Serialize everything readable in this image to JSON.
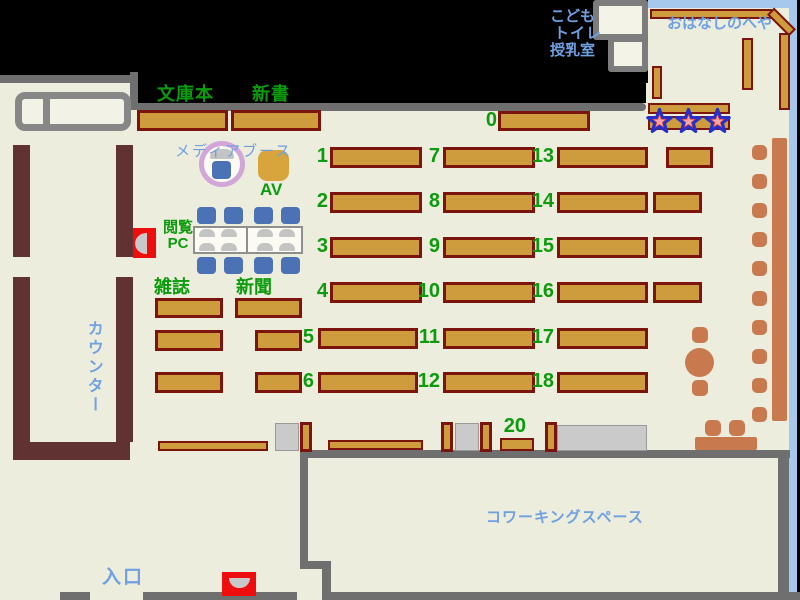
{
  "palette": {
    "green": "#0C9B0C",
    "blue": "#6FA0E2",
    "shelf_fill": "#CF9C3D",
    "shelf_border": "#7B150C",
    "counter_brown": "#603231",
    "wall_grey": "#6F6F6F",
    "floor_beige": "#EDEDDD",
    "salmon": "#C9794E",
    "chair_blue": "#4B72B5",
    "window_blue": "#A6C8EC",
    "return_red": "#EE0E0E",
    "star_red": "#E03434",
    "star_outline": "#2430CC",
    "media_ring_plum": "#D2A6D8"
  },
  "area_labels": [
    {
      "name": "label-bunkobon",
      "text": "文庫本",
      "x": 157,
      "y": 85,
      "size": 18,
      "weight": 700,
      "color": "green",
      "spacing": 1
    },
    {
      "name": "label-shinsho",
      "text": "新書",
      "x": 252,
      "y": 85,
      "size": 18,
      "weight": 700,
      "color": "green",
      "spacing": 1
    },
    {
      "name": "label-zasshi",
      "text": "雑誌",
      "x": 154,
      "y": 278,
      "size": 18,
      "weight": 700,
      "color": "green",
      "spacing": 0
    },
    {
      "name": "label-shinbun",
      "text": "新聞",
      "x": 236,
      "y": 278,
      "size": 18,
      "weight": 700,
      "color": "green",
      "spacing": 0
    },
    {
      "name": "label-av",
      "text": "AV",
      "x": 260,
      "y": 181,
      "size": 17,
      "weight": 700,
      "color": "green",
      "spacing": 0
    },
    {
      "name": "label-etsuran-pc",
      "text": "閲覧\nPC",
      "x": 163,
      "y": 220,
      "size": 15,
      "weight": 700,
      "color": "green",
      "spacing": 0,
      "align": "center"
    },
    {
      "name": "label-media-booth",
      "text": "メディアブース",
      "x": 175,
      "y": 144,
      "size": 15,
      "weight": 400,
      "color": "blue",
      "spacing": 2
    },
    {
      "name": "label-counter",
      "text": "カウンター",
      "x": 84,
      "y": 320,
      "size": 16,
      "weight": 600,
      "color": "blue",
      "spacing": 3,
      "vertical": true
    },
    {
      "name": "label-entrance",
      "text": "入口",
      "x": 102,
      "y": 568,
      "size": 19,
      "weight": 700,
      "color": "blue",
      "spacing": 2
    },
    {
      "name": "label-coworking",
      "text": "コワーキングスペース",
      "x": 486,
      "y": 510,
      "size": 15,
      "weight": 600,
      "color": "blue",
      "spacing": 1
    },
    {
      "name": "label-kids",
      "text": "こども",
      "x": 550,
      "y": 9,
      "size": 15,
      "weight": 700,
      "color": "blue",
      "spacing": 0
    },
    {
      "name": "label-toilet",
      "text": "トイレ",
      "x": 554,
      "y": 26,
      "size": 15,
      "weight": 700,
      "color": "blue",
      "spacing": 1
    },
    {
      "name": "label-nursing",
      "text": "授乳室",
      "x": 550,
      "y": 43,
      "size": 15,
      "weight": 700,
      "color": "blue",
      "spacing": 0
    },
    {
      "name": "label-ohanashi-room",
      "text": "おはなしのへや",
      "x": 667,
      "y": 16,
      "size": 15,
      "weight": 600,
      "color": "blue",
      "spacing": 0
    }
  ],
  "shelf_numbers": [
    {
      "text": "0",
      "right": 497,
      "top": 110
    },
    {
      "text": "1",
      "right": 328,
      "top": 146
    },
    {
      "text": "2",
      "right": 328,
      "top": 191
    },
    {
      "text": "3",
      "right": 328,
      "top": 236
    },
    {
      "text": "4",
      "right": 328,
      "top": 281
    },
    {
      "text": "5",
      "right": 314,
      "top": 327
    },
    {
      "text": "6",
      "right": 314,
      "top": 371
    },
    {
      "text": "7",
      "right": 440,
      "top": 146
    },
    {
      "text": "8",
      "right": 440,
      "top": 191
    },
    {
      "text": "9",
      "right": 440,
      "top": 236
    },
    {
      "text": "10",
      "right": 440,
      "top": 281
    },
    {
      "text": "11",
      "right": 440,
      "top": 327
    },
    {
      "text": "12",
      "right": 440,
      "top": 371
    },
    {
      "text": "13",
      "right": 554,
      "top": 146
    },
    {
      "text": "14",
      "right": 554,
      "top": 191
    },
    {
      "text": "15",
      "right": 554,
      "top": 236
    },
    {
      "text": "16",
      "right": 554,
      "top": 281
    },
    {
      "text": "17",
      "right": 554,
      "top": 327
    },
    {
      "text": "18",
      "right": 554,
      "top": 371
    },
    {
      "text": "20",
      "right": 526,
      "top": 416
    }
  ]
}
